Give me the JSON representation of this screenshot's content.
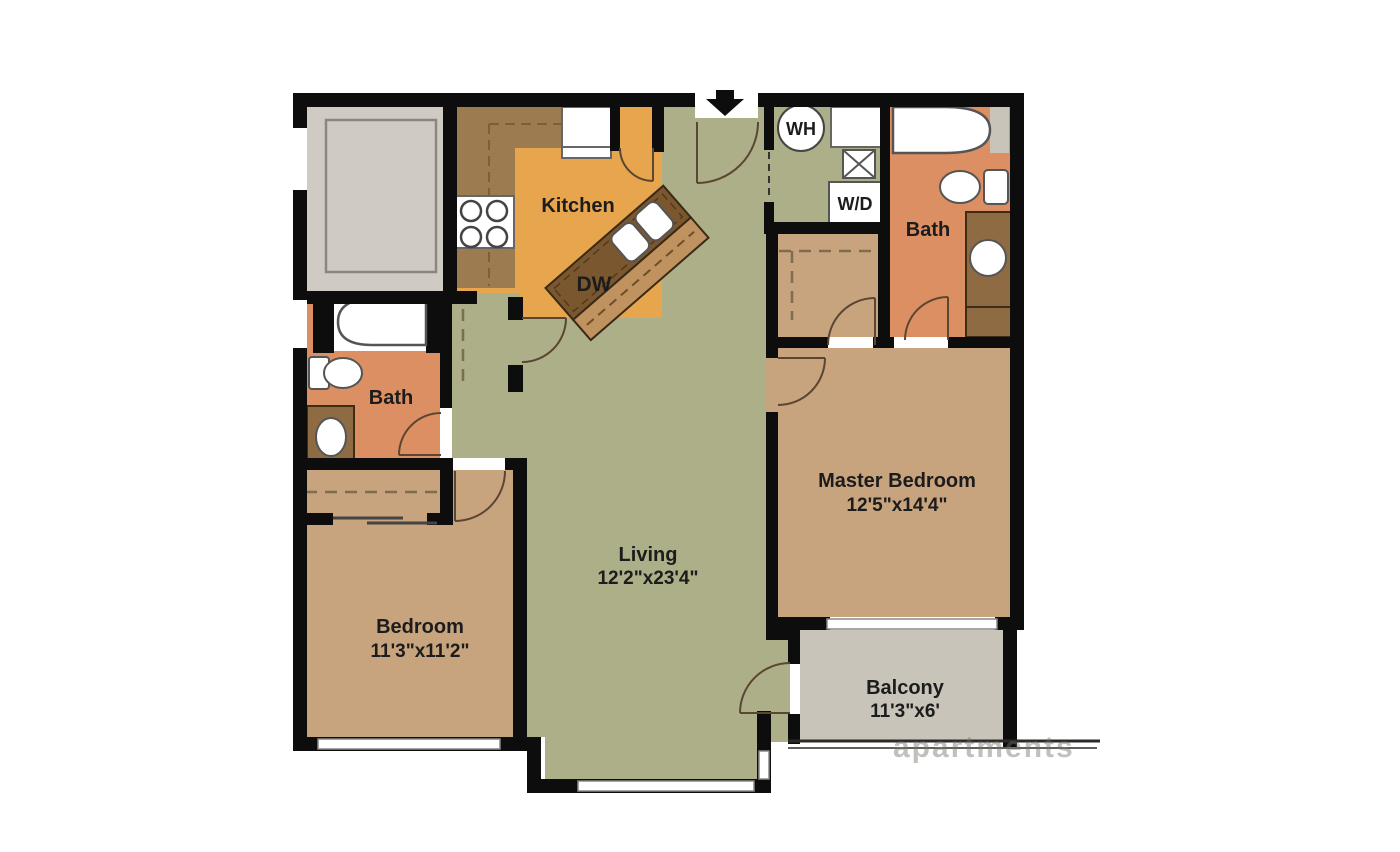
{
  "floor_plan": {
    "type": "apartment-floor-plan",
    "rooms": {
      "kitchen": {
        "label": "Kitchen"
      },
      "living": {
        "label": "Living",
        "dimensions": "12'2\"x23'4\""
      },
      "master_bedroom": {
        "label": "Master Bedroom",
        "dimensions": "12'5\"x14'4\""
      },
      "bedroom": {
        "label": "Bedroom",
        "dimensions": "11'3\"x11'2\""
      },
      "master_bath": {
        "label": "Bath"
      },
      "bath": {
        "label": "Bath"
      },
      "balcony": {
        "label": "Balcony",
        "dimensions": "11'3\"x6'"
      }
    },
    "appliances": {
      "dishwasher": {
        "label": "DW"
      },
      "water_heater": {
        "label": "WH"
      },
      "washer_dryer": {
        "label": "W/D"
      }
    },
    "watermark": "apartments",
    "colors": {
      "wall": "#0d0d0d",
      "living_green": "#acaf87",
      "kitchen_orange": "#e7a54e",
      "counter_brown": "#9b7b4f",
      "island_brown": "#7b572f",
      "island_bar": "#bf9260",
      "bedroom_tan": "#c8a47e",
      "bath_salmon": "#dc8f63",
      "vanity_brown": "#8f6b43",
      "patio_gray": "#cfcac2",
      "balcony_gray": "#c9c4ba"
    }
  }
}
